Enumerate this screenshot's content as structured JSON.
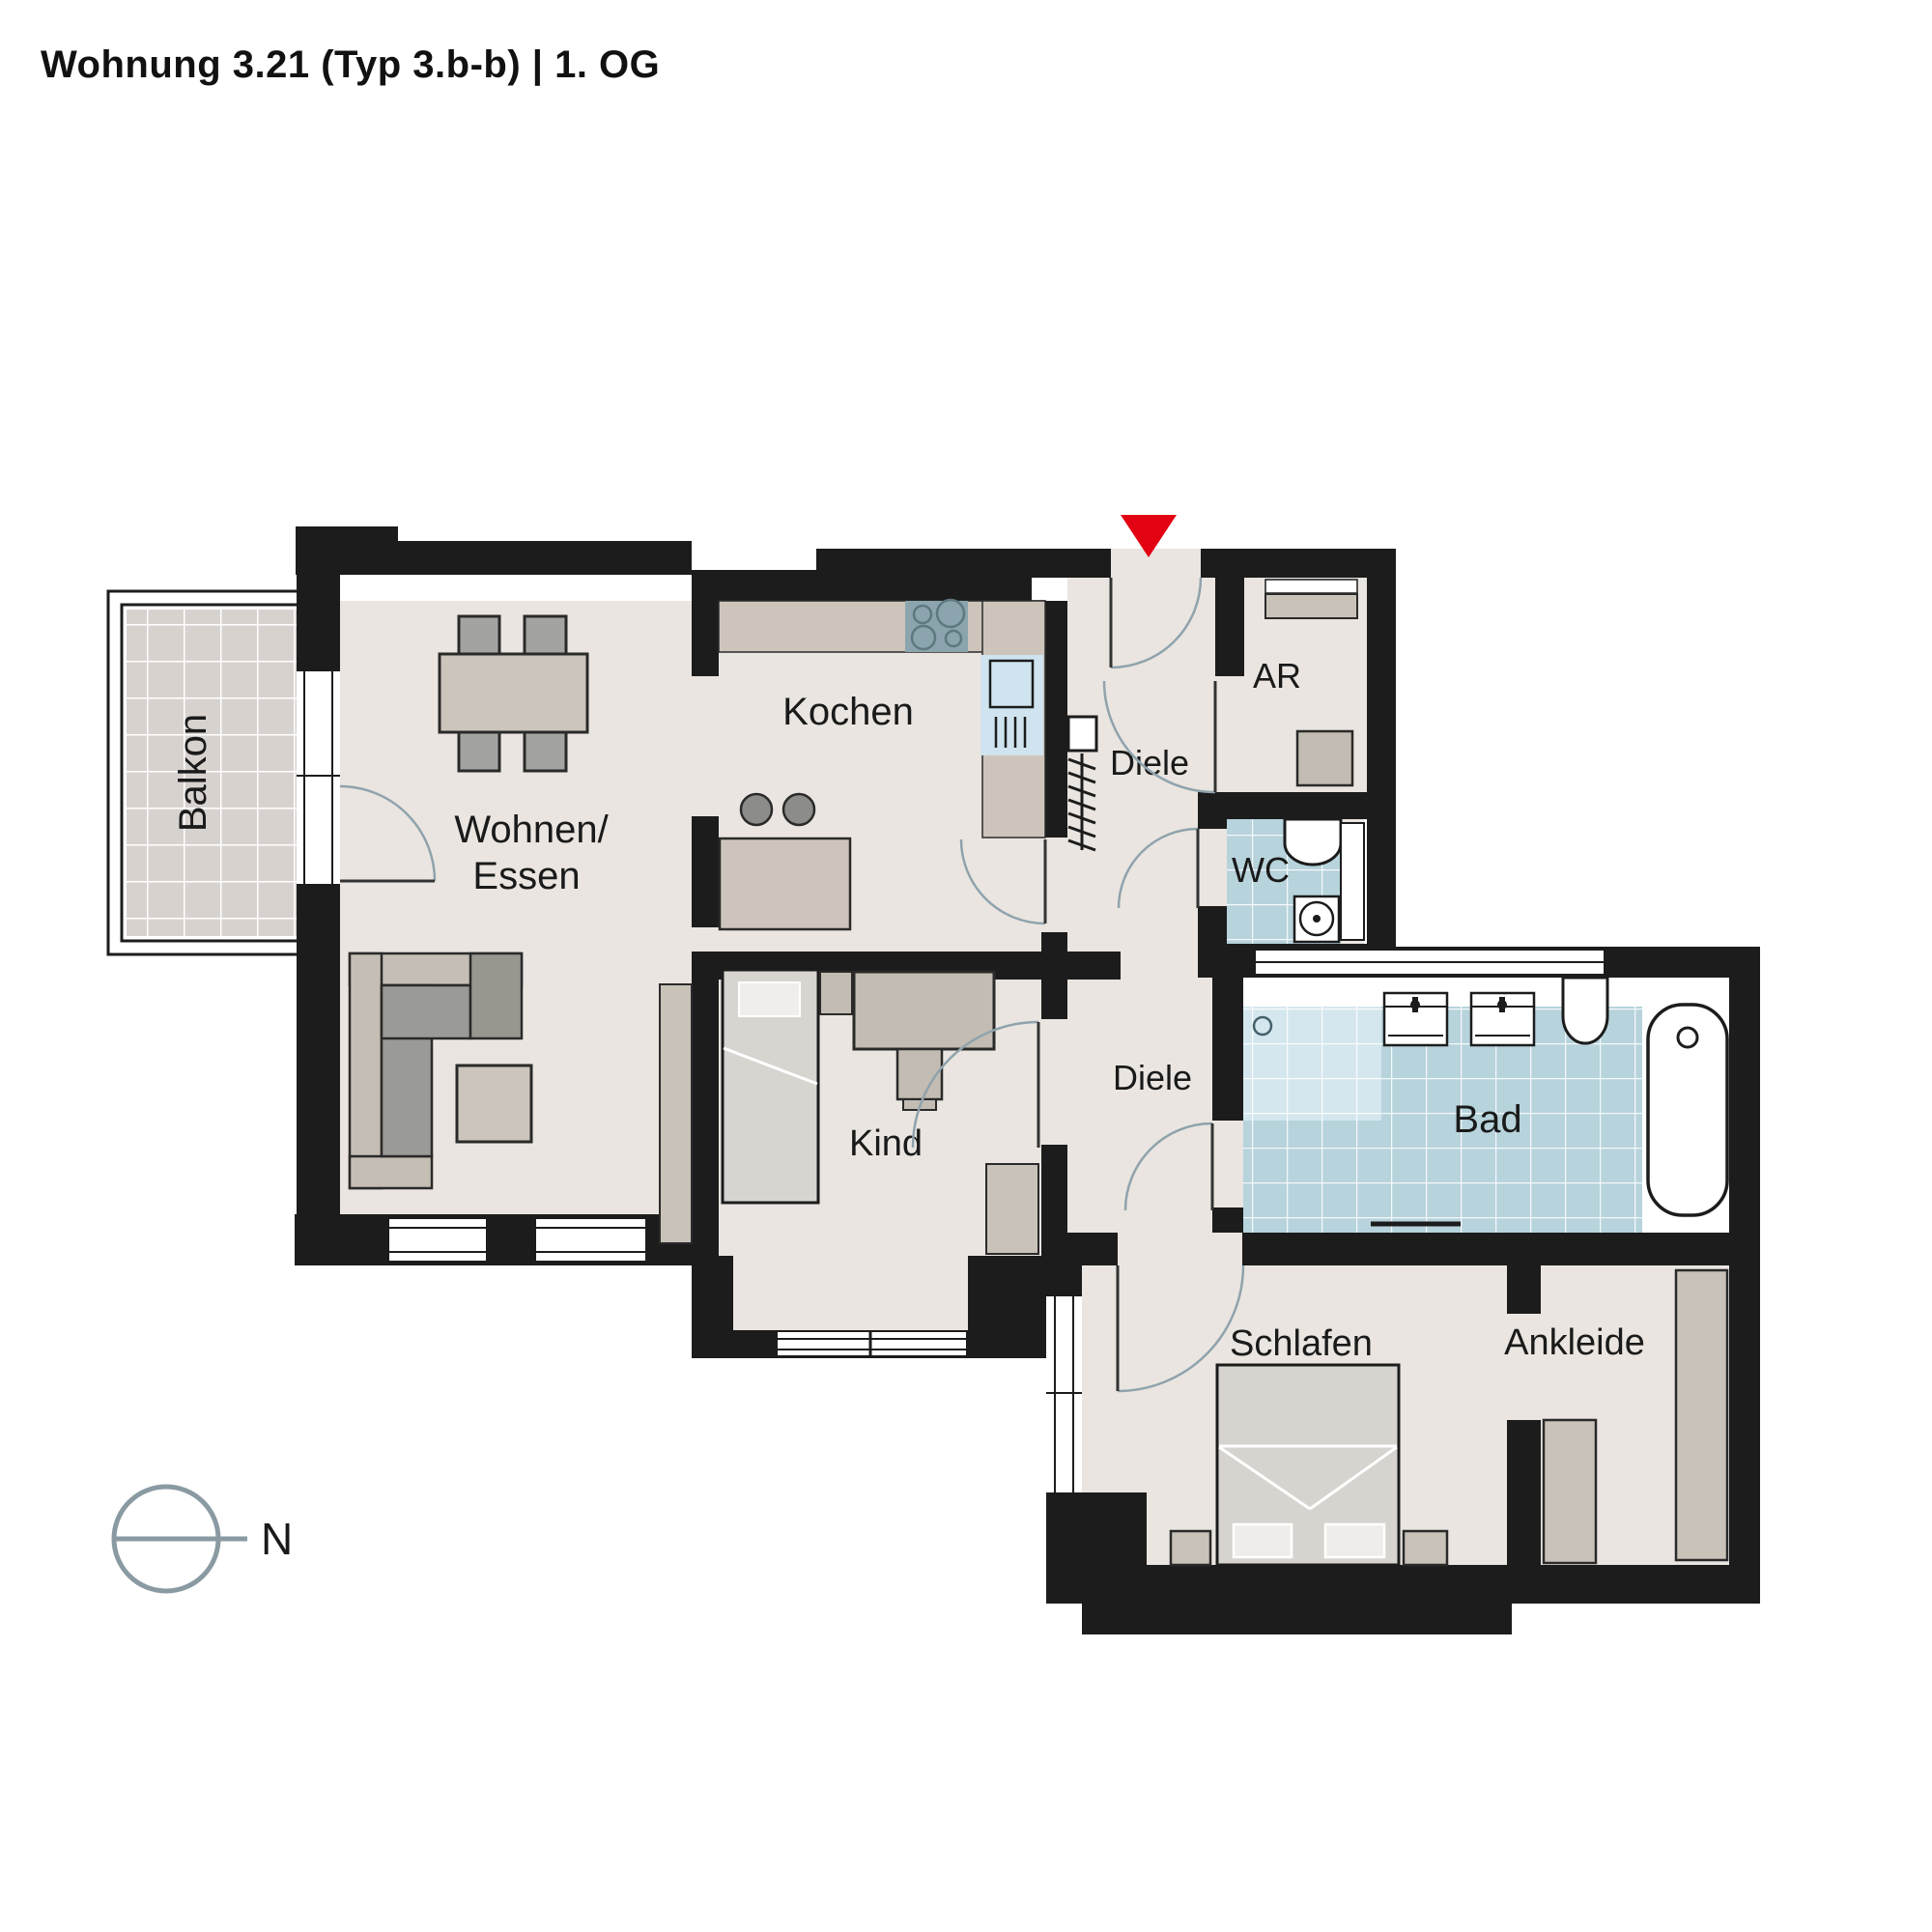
{
  "header": {
    "title": "Wohnung 3.21 (Typ 3.b-b) | 1. OG"
  },
  "compass": {
    "label": "N"
  },
  "entrance": {
    "marker": "entrance-arrow",
    "color": "#e30212"
  },
  "rooms": {
    "balkon": {
      "label": "Balkon"
    },
    "wohnen": {
      "label_line1": "Wohnen/",
      "label_line2": "Essen"
    },
    "kochen": {
      "label": "Kochen"
    },
    "diele_upper": {
      "label": "Diele"
    },
    "ar": {
      "label": "AR"
    },
    "wc": {
      "label": "WC"
    },
    "bad": {
      "label": "Bad"
    },
    "diele_lower": {
      "label": "Diele"
    },
    "kind": {
      "label": "Kind"
    },
    "schlafen": {
      "label": "Schlafen"
    },
    "ankleide": {
      "label": "Ankleide"
    }
  },
  "colors": {
    "wall": "#1c1c1c",
    "floor": "#eae5e0",
    "tile_bath": "#b7d3dc",
    "tile_shower": "#d4e7ee",
    "tile_balcony": "#d8d2cf",
    "furniture_light": "#ccc5bb",
    "furniture_mid": "#a3a3a0",
    "furniture_dark": "#9a9a96",
    "accent_red": "#e30212",
    "compass_gray": "#8a9aa2",
    "door_arc": "#8fa3ad"
  }
}
